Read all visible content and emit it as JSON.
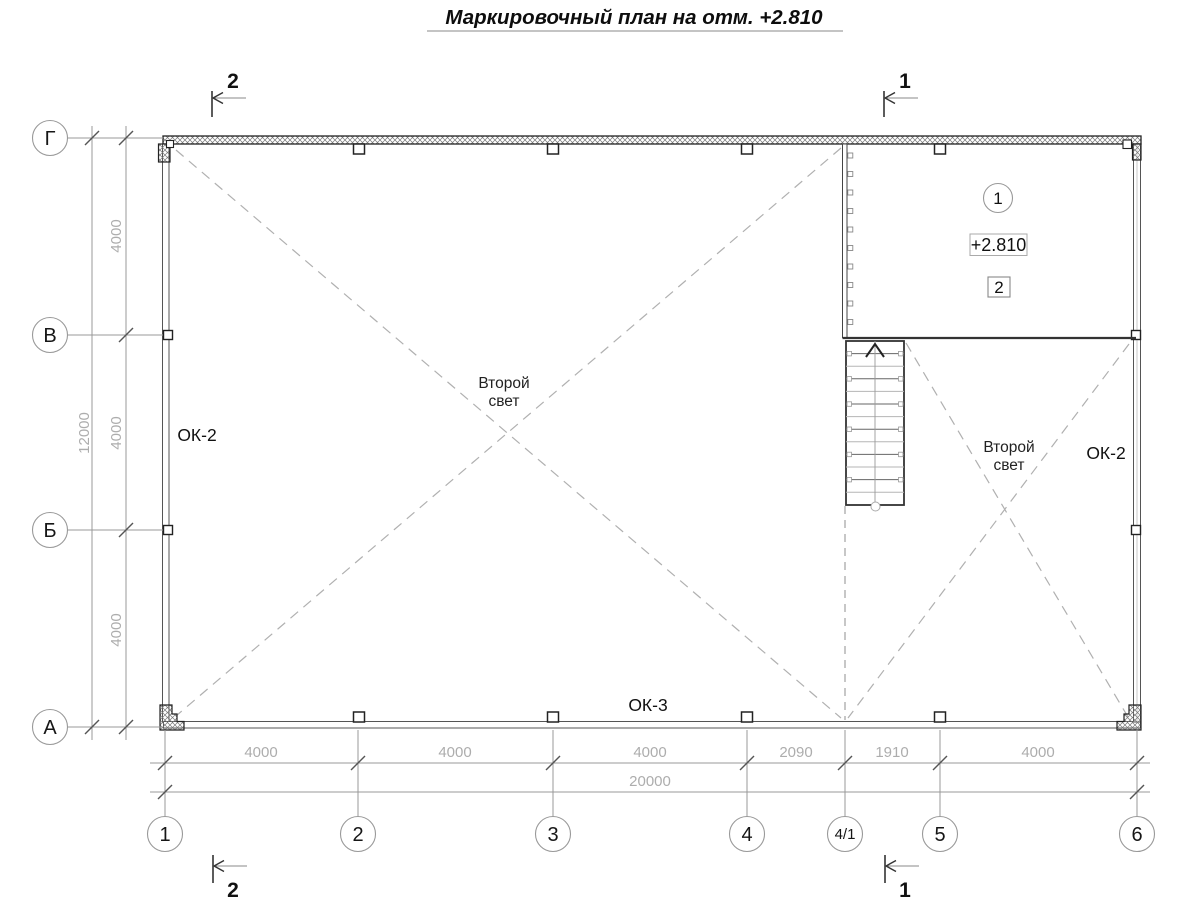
{
  "title": "Маркировочный план на отм. +2.810",
  "axes": {
    "horizontal": [
      "1",
      "2",
      "3",
      "4",
      "4/1",
      "5",
      "6"
    ],
    "vertical": [
      "Г",
      "В",
      "Б",
      "А"
    ]
  },
  "dimensions": {
    "bottom_segments": [
      "4000",
      "4000",
      "4000",
      "2090",
      "1910",
      "4000"
    ],
    "bottom_total": "20000",
    "left_segments": [
      "4000",
      "4000",
      "4000"
    ],
    "left_total": "12000"
  },
  "section_markers": {
    "section_1": "1",
    "section_2": "2"
  },
  "room_markers": {
    "position_number": "1",
    "elevation": "+2.810",
    "detail_number": "2"
  },
  "labels": {
    "window_left": "ОК-2",
    "window_right": "ОК-2",
    "window_bottom": "ОК-3",
    "second_light_left": {
      "line1": "Второй",
      "line2": "свет"
    },
    "second_light_right": {
      "line1": "Второй",
      "line2": "свет"
    }
  },
  "colors": {
    "wall_line": "#222222",
    "window_wall_line": "#555555",
    "axis_line": "#999999",
    "dim_text": "#adadad",
    "dashed_void_line": "#b0b0b0",
    "text": "#111111"
  }
}
